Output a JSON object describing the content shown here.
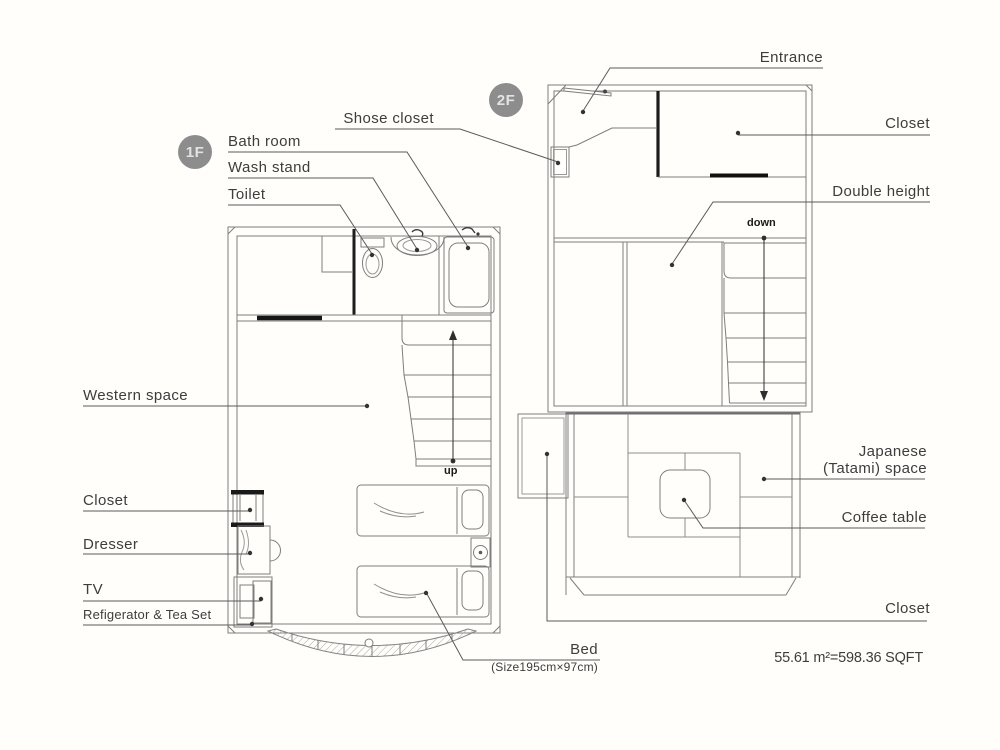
{
  "floor1": {
    "badge": "1F",
    "labels": {
      "bath_room": "Bath room",
      "wash_stand": "Wash stand",
      "toilet": "Toilet",
      "shose_closet": "Shose closet",
      "western_space": "Western space",
      "closet": "Closet",
      "dresser": "Dresser",
      "tv": "TV",
      "refrigerator": "Refigerator & Tea Set",
      "bed": "Bed",
      "bed_size": "(Size195cm×97cm)",
      "up": "up"
    }
  },
  "floor2": {
    "badge": "2F",
    "labels": {
      "entrance": "Entrance",
      "closet_top": "Closet",
      "double_height": "Double height",
      "down": "down",
      "japanese_line1": "Japanese",
      "japanese_line2": "(Tatami) space",
      "coffee_table": "Coffee table",
      "closet_bottom": "Closet"
    }
  },
  "footer": {
    "area": "55.61 m²=598.36 SQFT"
  },
  "colors": {
    "wall_line": "#7e7e7e",
    "dark_line": "#1c1c1c",
    "leader_line": "#5a5a5a",
    "label_text": "#3d3d3d",
    "badge_bg": "#8d8d8d"
  }
}
